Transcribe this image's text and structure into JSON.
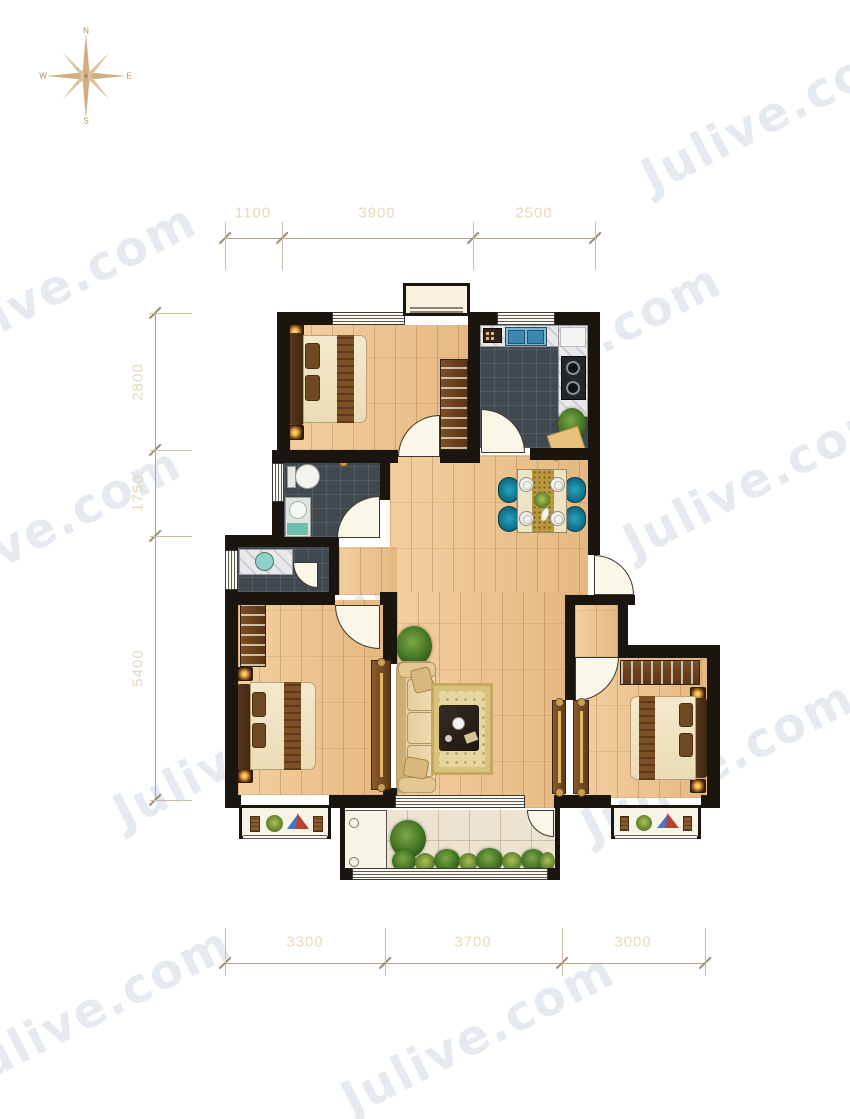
{
  "watermark": {
    "text": "Julive.com"
  },
  "compass": {
    "north": "N",
    "east": "E",
    "south": "S",
    "west": "W"
  },
  "dimensions": {
    "top": [
      "1100",
      "3900",
      "2500"
    ],
    "left": [
      "2800",
      "1750",
      "5400"
    ],
    "bottom": [
      "3300",
      "3700",
      "3000"
    ]
  },
  "colors": {
    "wall": "#1a160f",
    "wood_floor": "#edc28c",
    "dark_tile": "#414950",
    "pale_tile": "#ece4d1",
    "dimension_line": "#b3a48e",
    "dimension_text": "#e6d9ba",
    "dining_chair_teal": "#12748c",
    "compass": "#c9a87c",
    "watermark": "#b0c0cd"
  }
}
